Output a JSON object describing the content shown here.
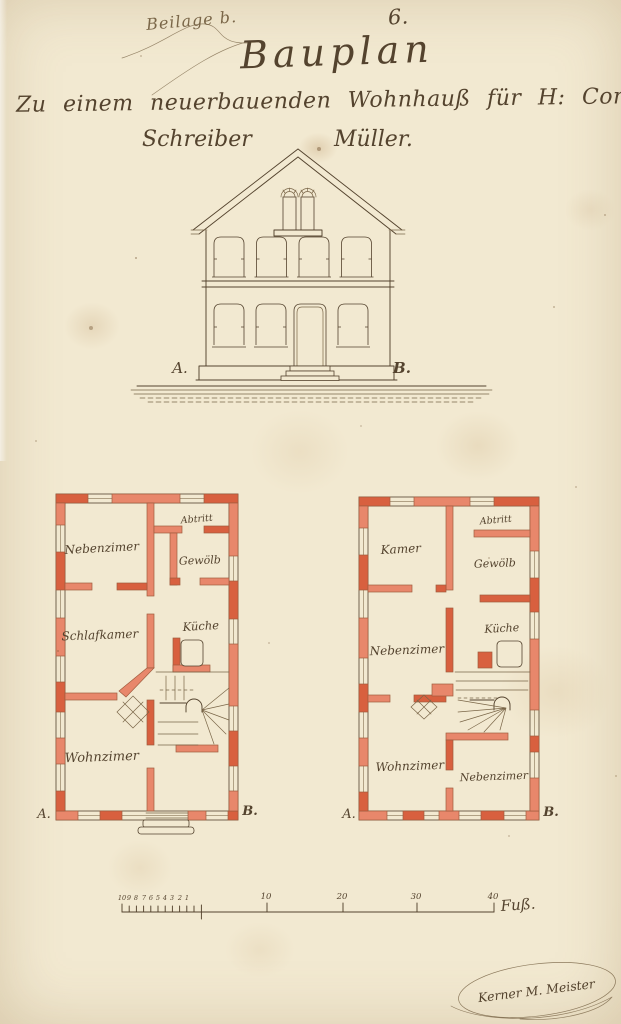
{
  "header": {
    "annotation": "Beilage b.",
    "page_number": "6.",
    "title": "Bauplan",
    "subtitle_line1": "Zu einem neuerbauenden Wohnhauß für H: Comunal=",
    "subtitle_left": "Schreiber",
    "subtitle_right": "Müller."
  },
  "elevation": {
    "marker_left": "A.",
    "marker_right": "B."
  },
  "plans": {
    "left": {
      "rooms": {
        "nebenzimmer": "Nebenzimer",
        "abtritt": "Abtritt",
        "gewoelb": "Gewölb",
        "schlafkammer": "Schlafkamer",
        "kueche": "Küche",
        "wohnzimmer": "Wohnzimer"
      },
      "marker_left": "A.",
      "marker_right": "B."
    },
    "right": {
      "rooms": {
        "kammer": "Kamer",
        "abtritt": "Abtritt",
        "gewoelb": "Gewölb",
        "nebenzimmer": "Nebenzimer",
        "kueche": "Küche",
        "wohnzimmer": "Wohnzimer",
        "nebenzimmer2": "Nebenzimer"
      },
      "marker_left": "A.",
      "marker_right": "B."
    }
  },
  "scale_bar": {
    "minor_labels": [
      "10",
      "9",
      "8",
      "7",
      "6",
      "5",
      "4",
      "3",
      "2",
      "1"
    ],
    "major_labels": [
      "10",
      "20",
      "30",
      "40"
    ],
    "unit": "Fuß."
  },
  "signature": "Kerner M. Meister",
  "colors": {
    "paper": "#f2e9d1",
    "ink": "#54432e",
    "ink_light": "#7a6648",
    "wall_red": "#e8876b",
    "wall_red_dark": "#d8603f"
  }
}
